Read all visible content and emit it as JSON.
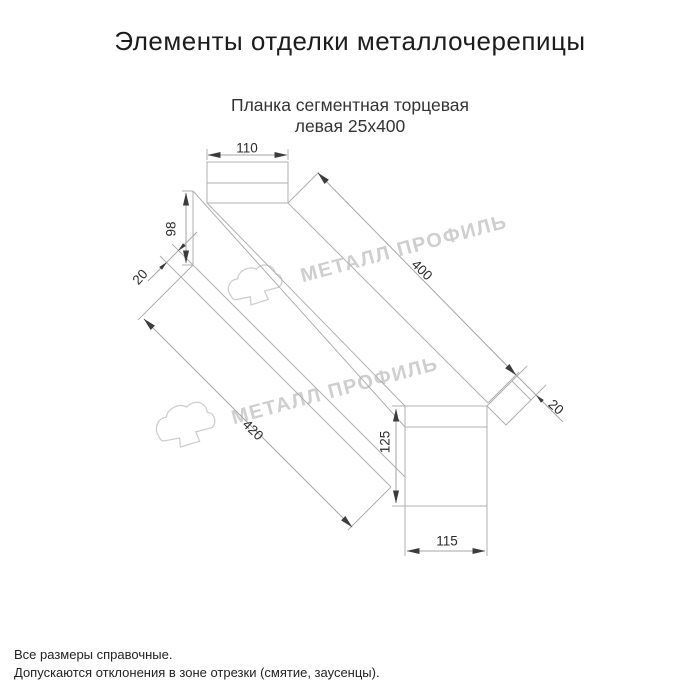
{
  "page": {
    "title": "Элементы отделки металлочерепицы"
  },
  "product": {
    "name_line1": "Планка сегментная торцевая",
    "name_line2": "левая 25х400"
  },
  "dimensions": {
    "top_width": "110",
    "left_height": "98",
    "left_fold": "20",
    "top_length": "400",
    "right_fold": "20",
    "bottom_length": "420",
    "right_height": "125",
    "right_width": "115"
  },
  "watermark": {
    "text": "МЕТАЛЛ ПРОФИЛЬ",
    "logo_icon": "cloud-logo-icon"
  },
  "footer": {
    "line1": "Все размеры справочные.",
    "line2": "Допускаются отклонения в зоне отрезки (смятие, заусенцы)."
  },
  "colors": {
    "background": "#ffffff",
    "line": "#b0b0b0",
    "dimension_line": "#a6a6a6",
    "arrow": "#3c3c3c",
    "text": "#2b2b2b",
    "title": "#1c1c1c",
    "watermark": "#cfcfcf"
  }
}
